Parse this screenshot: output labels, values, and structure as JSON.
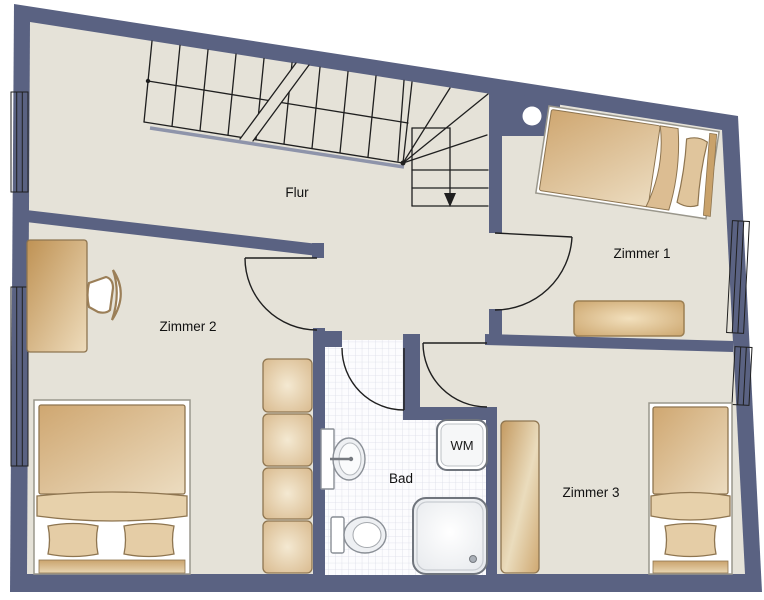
{
  "floorplan": {
    "type": "apartment-floor-plan",
    "labels": {
      "hallway": "Flur",
      "room1": "Zimmer 1",
      "room2": "Zimmer 2",
      "room3": "Zimmer 3",
      "bathroom": "Bad",
      "washing_machine": "WM"
    },
    "colors": {
      "wall": "#5a6282",
      "floor": "#e5e2d8",
      "tile_line": "#dbdce8",
      "furniture_tan_dark": "#bf9254",
      "furniture_tan_light": "#eedcbc",
      "fixture_outline": "#70757d",
      "background": "#ffffff"
    }
  }
}
